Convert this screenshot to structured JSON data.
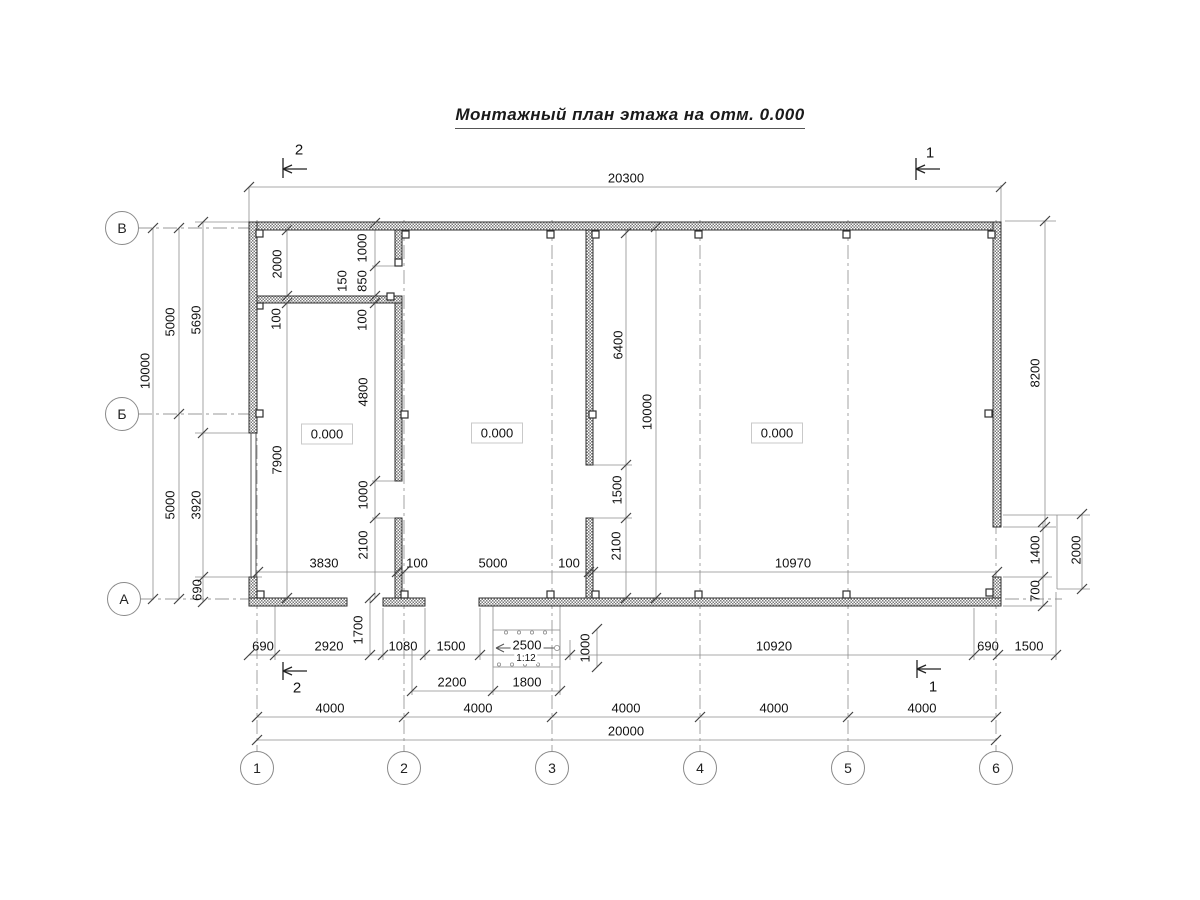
{
  "title": "Монтажный план этажа на отм. 0.000",
  "drawing": {
    "room_elevations": [
      {
        "label": "0.000",
        "x": 327,
        "y": 434
      },
      {
        "label": "0.000",
        "x": 497,
        "y": 433
      },
      {
        "label": "0.000",
        "x": 777,
        "y": 433
      }
    ],
    "axis_circles_left": [
      {
        "label": "В",
        "x": 122,
        "y": 228
      },
      {
        "label": "Б",
        "x": 122,
        "y": 414
      },
      {
        "label": "А",
        "x": 124,
        "y": 599
      }
    ],
    "axis_circles_bottom": [
      {
        "label": "1",
        "x": 257,
        "y": 768
      },
      {
        "label": "2",
        "x": 404,
        "y": 768
      },
      {
        "label": "3",
        "x": 552,
        "y": 768
      },
      {
        "label": "4",
        "x": 700,
        "y": 768
      },
      {
        "label": "5",
        "x": 848,
        "y": 768
      },
      {
        "label": "6",
        "x": 996,
        "y": 768
      }
    ],
    "section_marks": [
      {
        "label": "2",
        "x": 299,
        "y": 150
      },
      {
        "label": "1",
        "x": 930,
        "y": 153
      },
      {
        "label": "2",
        "x": 297,
        "y": 688
      },
      {
        "label": "1",
        "x": 933,
        "y": 687
      }
    ],
    "dimensions": [
      {
        "text": "20300",
        "x": 626,
        "y": 178
      },
      {
        "text": "3830",
        "x": 324,
        "y": 563
      },
      {
        "text": "100",
        "x": 417,
        "y": 563
      },
      {
        "text": "5000",
        "x": 493,
        "y": 563
      },
      {
        "text": "100",
        "x": 569,
        "y": 563
      },
      {
        "text": "10970",
        "x": 793,
        "y": 563
      },
      {
        "text": "690",
        "x": 263,
        "y": 646
      },
      {
        "text": "2920",
        "x": 329,
        "y": 646
      },
      {
        "text": "1080",
        "x": 403,
        "y": 646
      },
      {
        "text": "1500",
        "x": 451,
        "y": 646
      },
      {
        "text": "2500",
        "x": 527,
        "y": 645,
        "bg": true
      },
      {
        "text": "1:12",
        "x": 526,
        "y": 659,
        "small": true,
        "bg": true
      },
      {
        "text": "10920",
        "x": 774,
        "y": 646
      },
      {
        "text": "690",
        "x": 988,
        "y": 646
      },
      {
        "text": "1500",
        "x": 1029,
        "y": 646
      },
      {
        "text": "2200",
        "x": 452,
        "y": 682
      },
      {
        "text": "1800",
        "x": 527,
        "y": 682
      },
      {
        "text": "4000",
        "x": 330,
        "y": 708
      },
      {
        "text": "4000",
        "x": 478,
        "y": 708
      },
      {
        "text": "4000",
        "x": 626,
        "y": 708
      },
      {
        "text": "4000",
        "x": 774,
        "y": 708
      },
      {
        "text": "4000",
        "x": 922,
        "y": 708
      },
      {
        "text": "20000",
        "x": 626,
        "y": 731
      },
      {
        "text": "10000",
        "x": 145,
        "y": 371,
        "rot": true
      },
      {
        "text": "5000",
        "x": 170,
        "y": 322,
        "rot": true
      },
      {
        "text": "5690",
        "x": 196,
        "y": 320,
        "rot": true
      },
      {
        "text": "5000",
        "x": 170,
        "y": 505,
        "rot": true
      },
      {
        "text": "3920",
        "x": 196,
        "y": 505,
        "rot": true
      },
      {
        "text": "690",
        "x": 197,
        "y": 590,
        "rot": true
      },
      {
        "text": "2000",
        "x": 277,
        "y": 264,
        "rot": true
      },
      {
        "text": "100",
        "x": 276,
        "y": 319,
        "rot": true
      },
      {
        "text": "7900",
        "x": 277,
        "y": 460,
        "rot": true
      },
      {
        "text": "1000",
        "x": 362,
        "y": 248,
        "rot": true
      },
      {
        "text": "850",
        "x": 362,
        "y": 281,
        "rot": true
      },
      {
        "text": "150",
        "x": 342,
        "y": 281,
        "rot": true
      },
      {
        "text": "100",
        "x": 362,
        "y": 320,
        "rot": true
      },
      {
        "text": "4800",
        "x": 363,
        "y": 392,
        "rot": true
      },
      {
        "text": "1000",
        "x": 363,
        "y": 495,
        "rot": true
      },
      {
        "text": "2100",
        "x": 363,
        "y": 545,
        "rot": true
      },
      {
        "text": "1700",
        "x": 358,
        "y": 630,
        "rot": true
      },
      {
        "text": "6400",
        "x": 618,
        "y": 345,
        "rot": true
      },
      {
        "text": "1500",
        "x": 617,
        "y": 490,
        "rot": true
      },
      {
        "text": "2100",
        "x": 616,
        "y": 546,
        "rot": true
      },
      {
        "text": "10000",
        "x": 647,
        "y": 412,
        "rot": true
      },
      {
        "text": "1000",
        "x": 585,
        "y": 648,
        "rot": true
      },
      {
        "text": "8200",
        "x": 1035,
        "y": 373,
        "rot": true
      },
      {
        "text": "1400",
        "x": 1035,
        "y": 550,
        "rot": true
      },
      {
        "text": "700",
        "x": 1035,
        "y": 591,
        "rot": true
      },
      {
        "text": "2000",
        "x": 1076,
        "y": 550,
        "rot": true
      }
    ]
  }
}
